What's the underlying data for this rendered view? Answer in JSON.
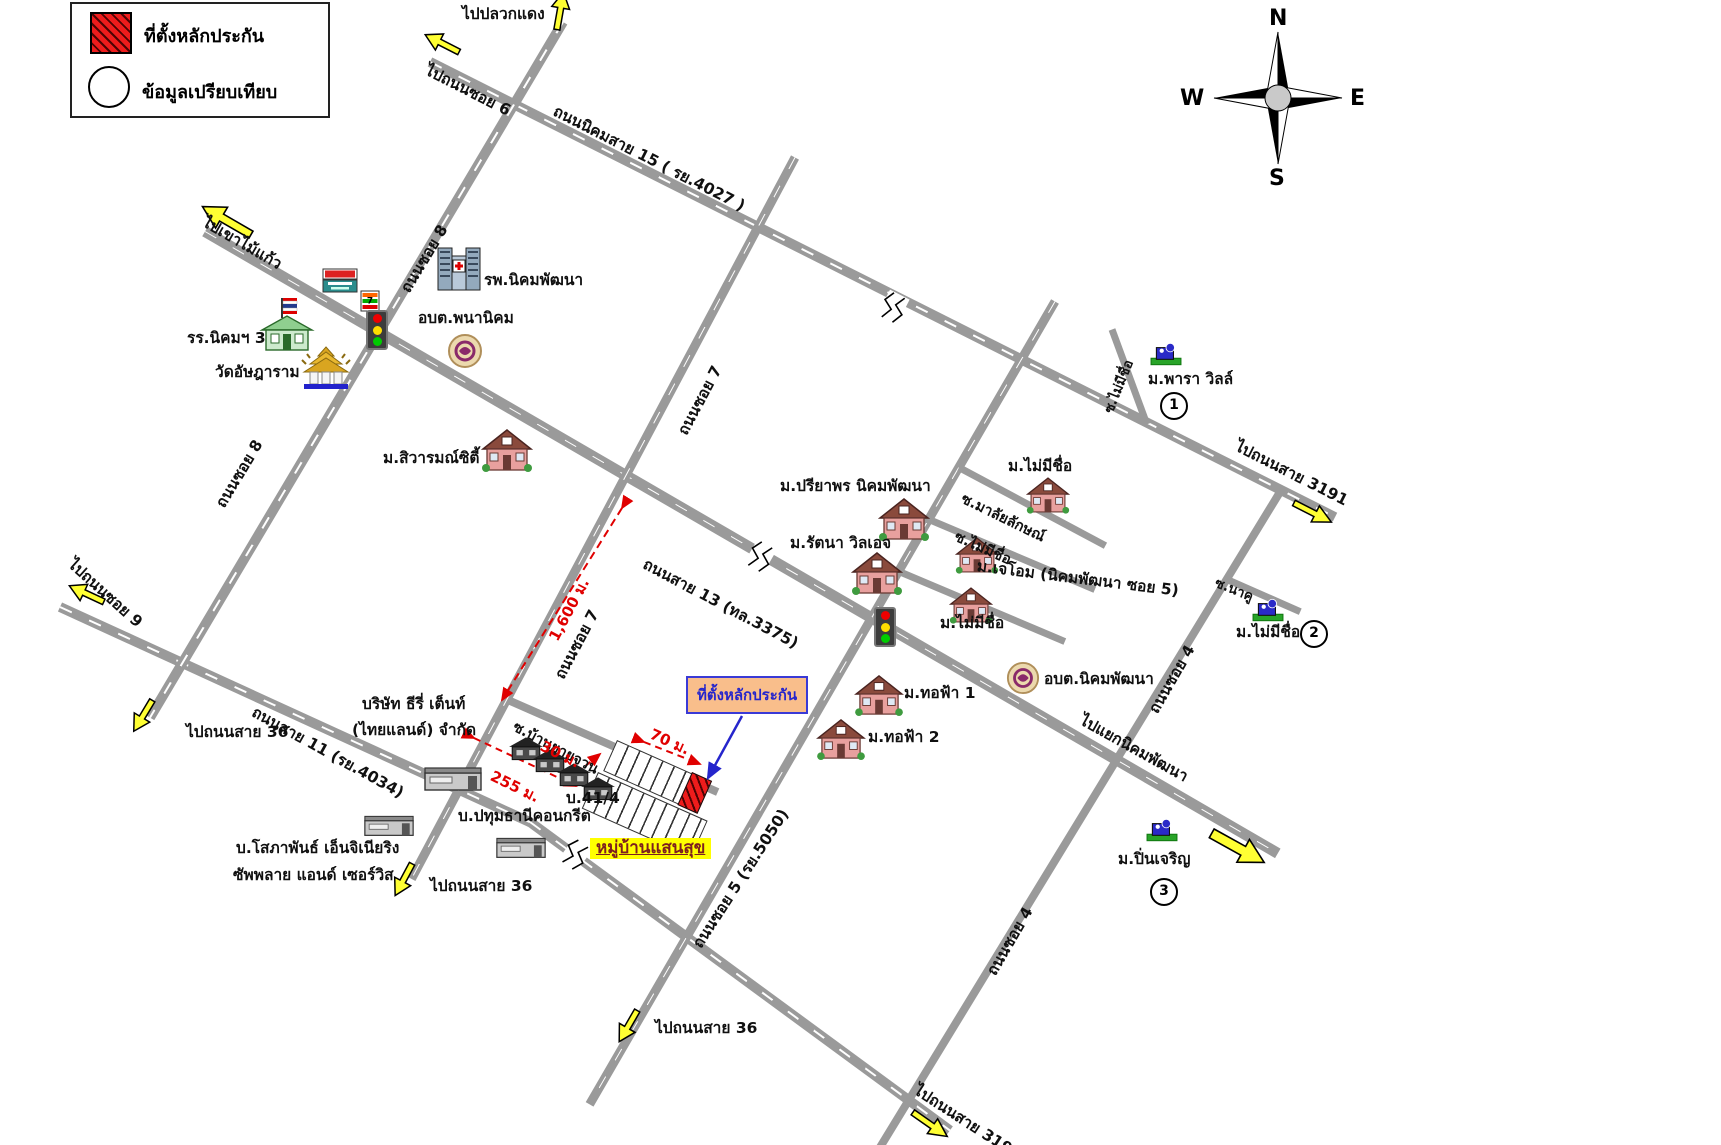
{
  "legend": {
    "collateral_label": "ที่ตั้งหลักประกัน",
    "comparison_label": "ข้อมูลเปรียบเทียบ"
  },
  "compass": {
    "north": "N",
    "south": "S",
    "east": "E",
    "west": "W"
  },
  "callout": {
    "text": "ที่ตั้งหลักประกัน"
  },
  "road_labels": [
    {
      "label": "ถนนนิคมสาย 15 ( รย.4027 )"
    },
    {
      "label": "ถนนซอย 8"
    },
    {
      "label": "ถนนซอย 8"
    },
    {
      "label": "ถนนซอย 7"
    },
    {
      "label": "ถนนซอย 7"
    },
    {
      "label": "ถนนสาย 13 (ทล.3375)"
    },
    {
      "label": "ถนนสาย 11 (รย.4034)"
    },
    {
      "label": "ถนนซอย 5 (รย.5050)"
    },
    {
      "label": "ถนนซอย 4"
    },
    {
      "label": "ถนนซอย 4"
    },
    {
      "label": "ซ.มาลัยลักษณ์"
    },
    {
      "label": "ซ.ไม่มีชื่อ"
    },
    {
      "label": "ซ.ไม่มีชื่อ"
    },
    {
      "label": "ซ.นาคู"
    },
    {
      "label": "ซ.บ้านยายจวน"
    }
  ],
  "destinations": [
    {
      "label": "ไปปลวกแดง"
    },
    {
      "label": "ไปถนนซอย 6"
    },
    {
      "label": "ไปเขาไม้แก้ว"
    },
    {
      "label": "ไปถนนซอย 9"
    },
    {
      "label": "ไปถนนสาย 36"
    },
    {
      "label": "ไปถนนสาย 36"
    },
    {
      "label": "ไปถนนสาย 36"
    },
    {
      "label": "ไปถนนสาย 3191"
    },
    {
      "label": "ไปแยกนิคมพัฒนา"
    },
    {
      "label": "ไปถนนสาย 3191"
    }
  ],
  "places": [
    {
      "label": "รพ.นิคมพัฒนา"
    },
    {
      "label": "อบต.พนานิคม"
    },
    {
      "label": "รร.นิคมฯ 3"
    },
    {
      "label": "วัดอัษฎาราม"
    },
    {
      "label": "ม.สิวารมณ์ซิตี้"
    },
    {
      "label": "ม.ปรียาพร นิคมพัฒนา"
    },
    {
      "label": "ม.รัตนา วิลเอจ"
    },
    {
      "label": "ม.ไม่มีชื่อ"
    },
    {
      "label": "ม.เจโอม (นิคมพัฒนา ซอย 5)"
    },
    {
      "label": "ม.ไม่มีชื่อ"
    },
    {
      "label": "ม.พารา วิลล์"
    },
    {
      "label": "ม.ไม่มีชื่อ"
    },
    {
      "label": "ม.ปิ่นเจริญ"
    },
    {
      "label": "อบต.นิคมพัฒนา"
    },
    {
      "label": "ม.ทอฟ้า 1"
    },
    {
      "label": "ม.ทอฟ้า 2"
    },
    {
      "label": "บริษัท ธีรี่ เต็นท์"
    },
    {
      "label": "(ไทยแลนด์) จำกัด"
    },
    {
      "label": "บ.ปทุมธานีคอนกรีต"
    },
    {
      "label": "บ.โสภาพันธ์ เอ็นจิเนียริง"
    },
    {
      "label": "ซัพพลาย แอนด์ เซอร์วิส"
    },
    {
      "label": "บ.41/4"
    },
    {
      "label": "หมู่บ้านแสนสุข"
    }
  ],
  "measurements": [
    {
      "label": "1,600 ม."
    },
    {
      "label": "70 ม."
    },
    {
      "label": "30 ม."
    },
    {
      "label": "255 ม."
    }
  ],
  "markers": {
    "m1": "1",
    "m2": "2",
    "m3": "3"
  },
  "colors": {
    "road": "#9a9a9a",
    "collateral_red": "#ee1c1c",
    "measure_red": "#e00000",
    "callout_fill": "#f9be8b",
    "callout_border": "#3a3ad6",
    "highlight_yellow": "#ffff00",
    "arrow_yellow": "#ffff33"
  }
}
